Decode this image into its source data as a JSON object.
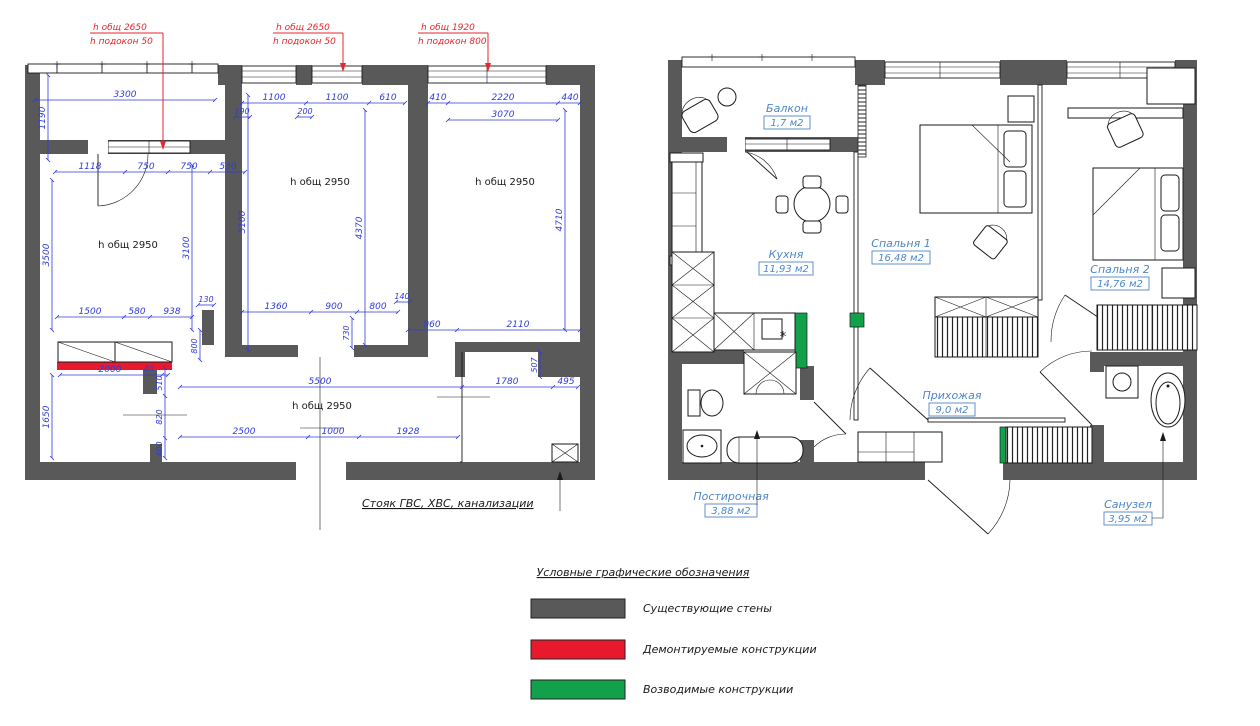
{
  "callouts": [
    {
      "h_total": "h общ 2650",
      "h_sill": "h подокон 50"
    },
    {
      "h_total": "h общ 2650",
      "h_sill": "h подокон 50"
    },
    {
      "h_total": "h общ 1920",
      "h_sill": "h подокон 800"
    }
  ],
  "left_plan": {
    "h_rooms": [
      "h общ 2950",
      "h общ 2950",
      "h общ 2950",
      "h общ 2950"
    ],
    "dims": {
      "d3300": "3300",
      "d1190": "1190",
      "d1118": "1118",
      "d750a": "750",
      "d750b": "750",
      "d530": "530",
      "d190": "190",
      "d1100a": "1100",
      "d200": "200",
      "d1100b": "1100",
      "d610": "610",
      "d410": "410",
      "d2220": "2220",
      "d440": "440",
      "d3070": "3070",
      "d3500": "3500",
      "d3100": "3100",
      "d5100": "5100",
      "d4370": "4370",
      "d4710": "4710",
      "d130": "130",
      "d1500": "1500",
      "d580": "580",
      "d938": "938",
      "d800v": "800",
      "d1360": "1360",
      "d900": "900",
      "d140": "140",
      "d800h": "800",
      "d730": "730",
      "d960": "960",
      "d2110": "2110",
      "d507": "507",
      "d5500": "5500",
      "d1780": "1780",
      "d495": "495",
      "d2000": "2000",
      "d80": "80",
      "d510": "510",
      "d820": "820",
      "d400": "400",
      "d1650": "1650",
      "d2500": "2500",
      "d1000": "1000",
      "d1928": "1928"
    },
    "riser_note": "Стояк ГВС, ХВС, канализации"
  },
  "right_plan": {
    "rooms": [
      {
        "name": "Балкон",
        "area": "1,7 м2"
      },
      {
        "name": "Кухня",
        "area": "11,93 м2"
      },
      {
        "name": "Спальня 1",
        "area": "16,48 м2"
      },
      {
        "name": "Спальня 2",
        "area": "14,76 м2"
      },
      {
        "name": "Прихожая",
        "area": "9,0 м2"
      },
      {
        "name": "Постирочная",
        "area": "3,88 м2"
      },
      {
        "name": "Санузел",
        "area": "3,95 м2"
      }
    ],
    "kitchen_star": "*"
  },
  "legend": {
    "title": "Условные графические обозначения",
    "items": [
      {
        "label": "Существующие стены",
        "color": "#595959"
      },
      {
        "label": "Демонтируемые конструкции",
        "color": "#e8192c"
      },
      {
        "label": "Возводимые конструкции",
        "color": "#12a04a"
      }
    ]
  },
  "colors": {
    "wall": "#595959",
    "dimension_blue": "#2f3bd9",
    "room_label_blue": "#4e87c7",
    "demolition_red": "#e8192c",
    "new_wall_green": "#12a04a"
  }
}
